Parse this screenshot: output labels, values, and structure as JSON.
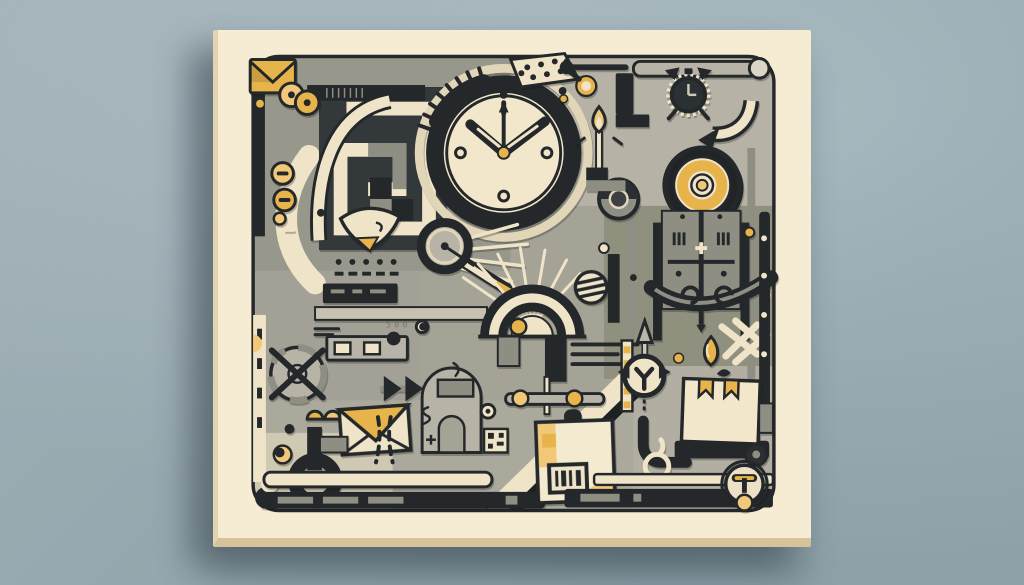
{
  "scene": {
    "description": "Abstract flat productivity-themed illustration printed on a cream canvas hanging on a blue-gray wall",
    "wall_color_top": "#b1c0c6",
    "wall_color_bottom": "#9cafb7",
    "canvas_color": "#f5ecd3",
    "canvas_side_color": "#e3d3af",
    "canvas_bottom_color": "#d6c39b",
    "shadow_color": "rgba(45,60,70,0.42)"
  },
  "palette": {
    "dark": "#24282a",
    "charcoal": "#33383a",
    "gray": "#a5a296",
    "gray_light": "#b7b4a7",
    "gray_mid": "#8f8e83",
    "cream": "#efe4c8",
    "cream_deep": "#e2d6b8",
    "gold": "#e7b34b",
    "gold_soft": "#f0c878",
    "ink_soft": "#6f6f66"
  },
  "artwork": {
    "box_text": "0079",
    "faint_number": "500",
    "icons": [
      {
        "name": "envelope-icon",
        "depicts": "gold envelope at top-left corner"
      },
      {
        "name": "maze-icon",
        "depicts": "interlocking greek-key maze blocks"
      },
      {
        "name": "coin-buttons-icon",
        "depicts": "gold coin buttons with slots"
      },
      {
        "name": "clock-icon",
        "depicts": "large wall clock reading about ten past ten"
      },
      {
        "name": "gear-arc-icon",
        "depicts": "gear tooth arc"
      },
      {
        "name": "dotted-wedge-icon",
        "depicts": "dotted cream wedge"
      },
      {
        "name": "alarm-clock-icon",
        "depicts": "dark alarm clock with bells"
      },
      {
        "name": "curved-arrow-icon",
        "depicts": "cream curved arrow"
      },
      {
        "name": "target-icon",
        "depicts": "gold bullseye target"
      },
      {
        "name": "match-flame-icon",
        "depicts": "burning match with gold flame"
      },
      {
        "name": "key-pin-icon",
        "depicts": "small gold ring pin"
      },
      {
        "name": "lens-icon",
        "depicts": "camera style lens disc"
      },
      {
        "name": "magnifier-icon",
        "depicts": "magnifying glass with gold handle"
      },
      {
        "name": "leaf-icon",
        "depicts": "cream leaf fan with gold tip"
      },
      {
        "name": "dot-matrix-icon",
        "depicts": "grid of dots and dashes"
      },
      {
        "name": "browser-card-icon",
        "depicts": "small card with two cream keys"
      },
      {
        "name": "globe-icon",
        "depicts": "crossed-out wheel globe"
      },
      {
        "name": "envelope2-icon",
        "depicts": "cream envelope with gold flap"
      },
      {
        "name": "chevron-arrows-icon",
        "depicts": "dark double chevrons"
      },
      {
        "name": "dome-candle-icon",
        "depicts": "dome shrine with candle"
      },
      {
        "name": "hook-icon",
        "depicts": "dark hook ring"
      },
      {
        "name": "arch-icon",
        "depicts": "striped rainbow arch with rays"
      },
      {
        "name": "striped-ball-icon",
        "depicts": "striped sphere"
      },
      {
        "name": "slider-icon",
        "depicts": "rail with two gold knobs"
      },
      {
        "name": "shipping-box-icon",
        "depicts": "parcel with barcode and number"
      },
      {
        "name": "gift-package-icon",
        "depicts": "parcel with gold ribbons on a cart"
      },
      {
        "name": "compass-spear-icon",
        "depicts": "compass dial with spear arrow"
      },
      {
        "name": "teardrop-icon",
        "depicts": "gold teardrop"
      },
      {
        "name": "trellis-icon",
        "depicts": "symmetric ornament panel"
      },
      {
        "name": "valve-icon",
        "depicts": "valve wheel with gold bar"
      },
      {
        "name": "qr-chip-icon",
        "depicts": "tiny qr-like chip"
      }
    ]
  }
}
